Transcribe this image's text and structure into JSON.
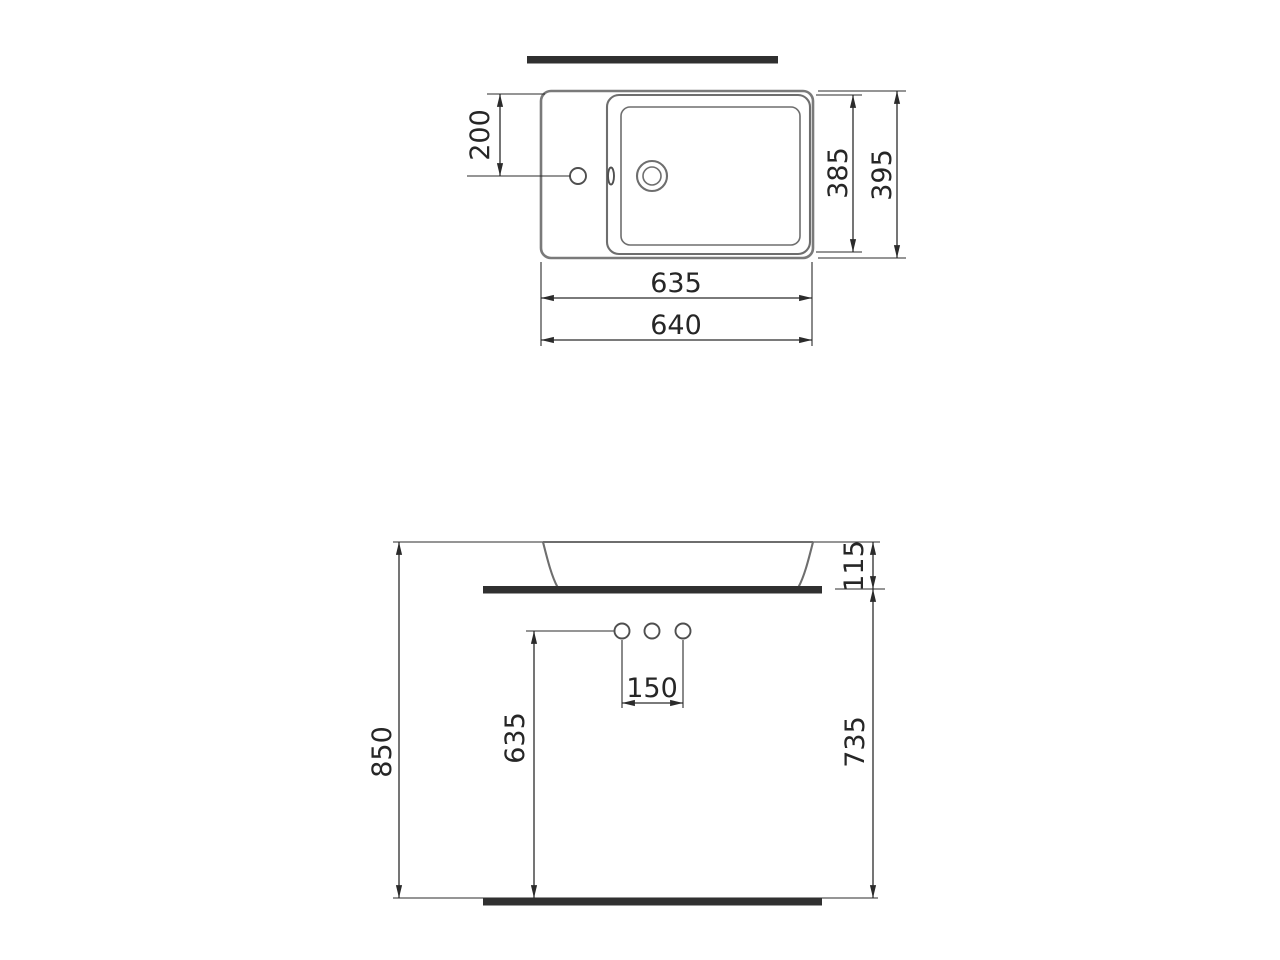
{
  "drawing": {
    "type": "technical-dimension-drawing",
    "subject": "rectangular countertop washbasin, plan view and front elevation",
    "views": {
      "top_view": {
        "name": "plan-view",
        "dims": {
          "hole_offset": "200",
          "inner_depth": "385",
          "outer_depth": "395",
          "inner_width": "635",
          "outer_width": "640"
        }
      },
      "front_view": {
        "name": "front-elevation",
        "dims": {
          "rim_height": "115",
          "overall_height": "850",
          "holes_height": "635",
          "counter_height": "735",
          "hole_spacing": "150"
        }
      }
    },
    "colors": {
      "background": "#ffffff",
      "outline_gray": "#7a7a7a",
      "detail_gray": "#4f4f4f",
      "dimension_dark": "#2b2b2b",
      "solid_bar": "#303030"
    }
  }
}
